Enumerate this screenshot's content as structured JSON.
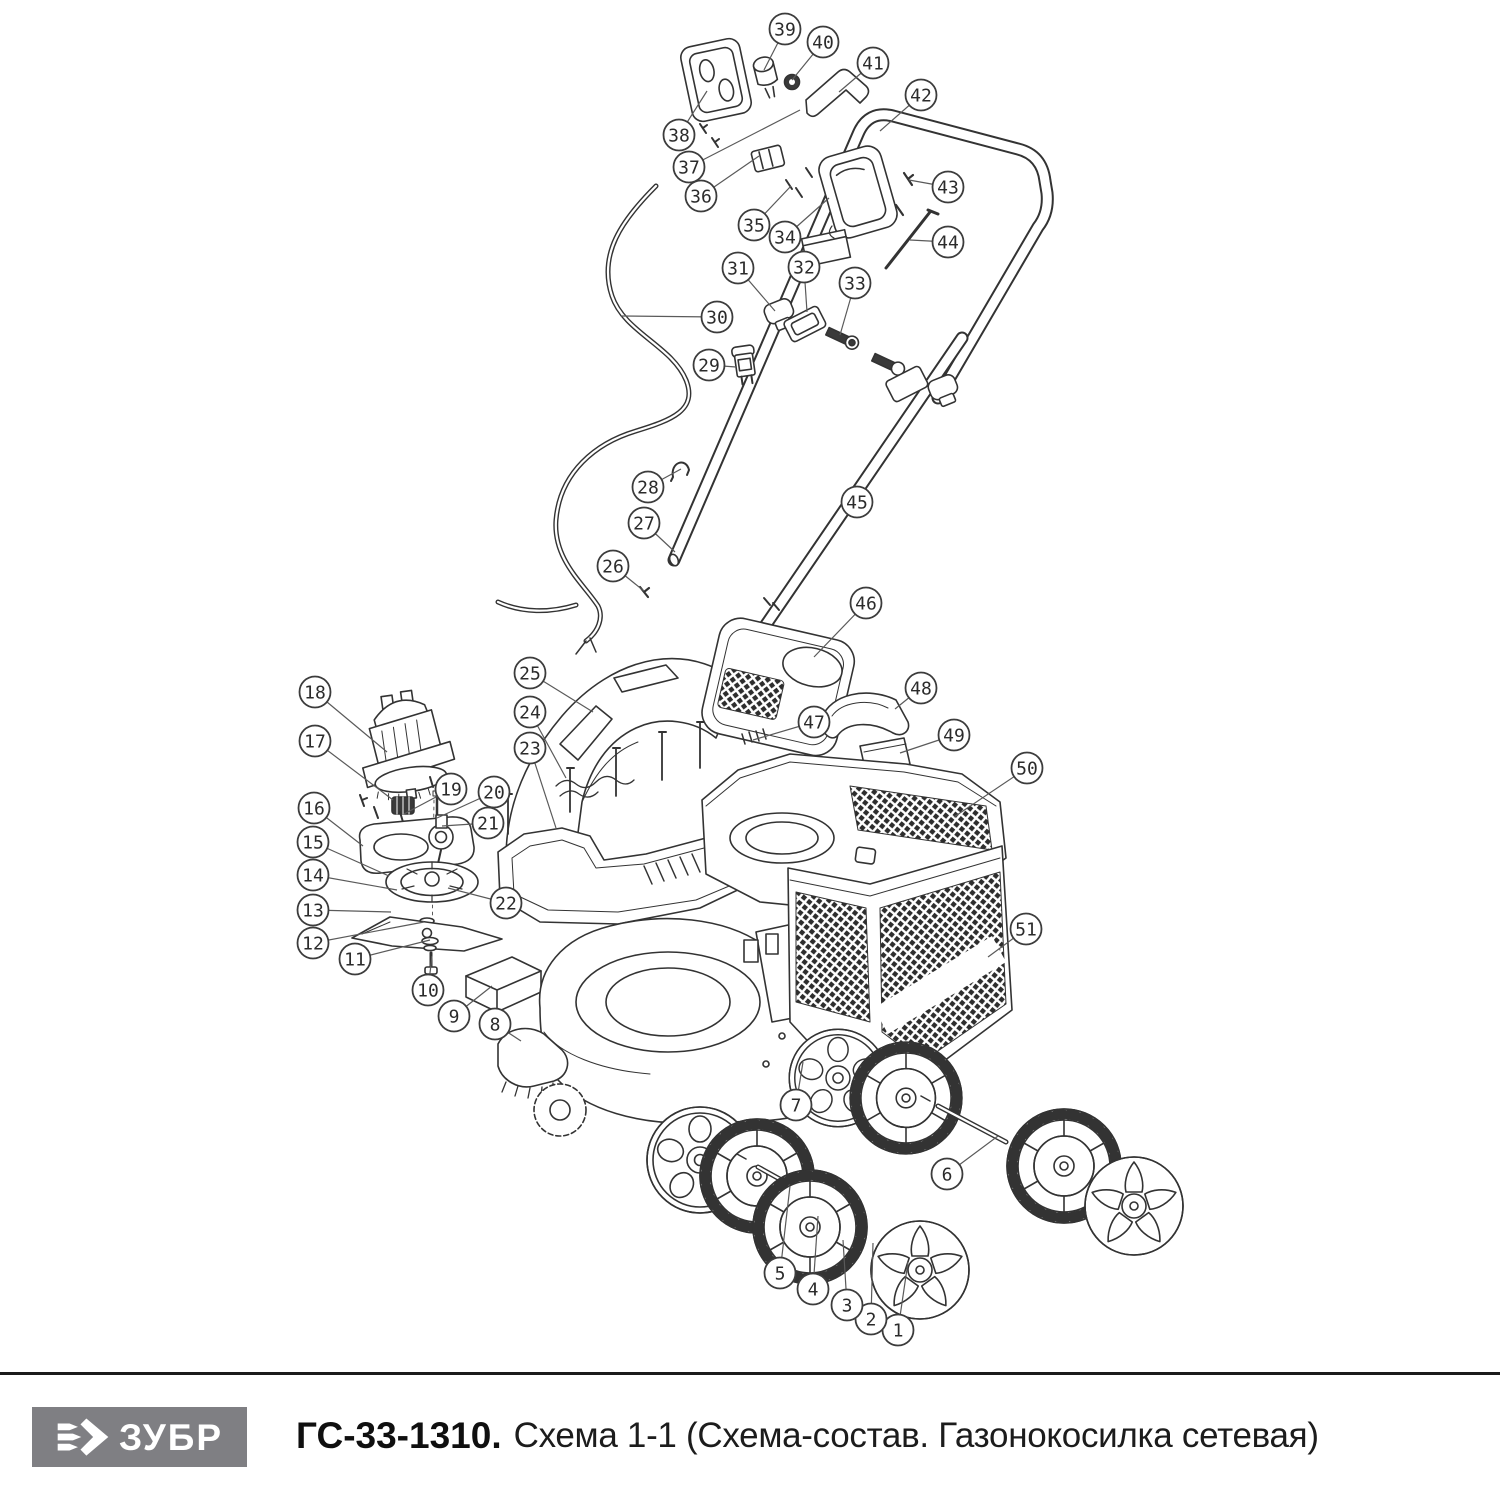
{
  "page": {
    "width": 1500,
    "height": 1500,
    "background": "#ffffff"
  },
  "diagram": {
    "type": "exploded-parts-diagram",
    "line_color": "#333333",
    "callout_style": {
      "radius": 15.5,
      "stroke": "#3c3c3c",
      "leader": "#5a5a5a",
      "number_color": "#2b2b2b",
      "font_size": 18
    },
    "callouts": [
      {
        "n": 1,
        "cx": 898,
        "cy": 1330,
        "tx": 908,
        "ty": 1262
      },
      {
        "n": 2,
        "cx": 871,
        "cy": 1319,
        "tx": 873,
        "ty": 1243
      },
      {
        "n": 3,
        "cx": 847,
        "cy": 1305,
        "tx": 843,
        "ty": 1240
      },
      {
        "n": 4,
        "cx": 813,
        "cy": 1289,
        "tx": 818,
        "ty": 1216
      },
      {
        "n": 5,
        "cx": 780,
        "cy": 1273,
        "tx": 790,
        "ty": 1186
      },
      {
        "n": 6,
        "cx": 947,
        "cy": 1174,
        "tx": 998,
        "ty": 1136
      },
      {
        "n": 7,
        "cx": 796,
        "cy": 1105,
        "tx": 803,
        "ty": 1062
      },
      {
        "n": 8,
        "cx": 495,
        "cy": 1024,
        "tx": 521,
        "ty": 1041
      },
      {
        "n": 9,
        "cx": 454,
        "cy": 1016,
        "tx": 492,
        "ty": 986
      },
      {
        "n": 10,
        "cx": 428,
        "cy": 990,
        "tx": 432,
        "ty": 956
      },
      {
        "n": 11,
        "cx": 355,
        "cy": 959,
        "tx": 430,
        "ty": 940
      },
      {
        "n": 12,
        "cx": 313,
        "cy": 943,
        "tx": 424,
        "ty": 922
      },
      {
        "n": 13,
        "cx": 313,
        "cy": 910,
        "tx": 391,
        "ty": 912
      },
      {
        "n": 14,
        "cx": 313,
        "cy": 875,
        "tx": 397,
        "ty": 890
      },
      {
        "n": 15,
        "cx": 313,
        "cy": 842,
        "tx": 389,
        "ty": 876
      },
      {
        "n": 16,
        "cx": 314,
        "cy": 808,
        "tx": 363,
        "ty": 846
      },
      {
        "n": 17,
        "cx": 315,
        "cy": 741,
        "tx": 393,
        "ty": 800
      },
      {
        "n": 18,
        "cx": 315,
        "cy": 692,
        "tx": 387,
        "ty": 752
      },
      {
        "n": 19,
        "cx": 451,
        "cy": 789,
        "tx": 404,
        "ty": 814
      },
      {
        "n": 20,
        "cx": 494,
        "cy": 792,
        "tx": 437,
        "ty": 818
      },
      {
        "n": 21,
        "cx": 488,
        "cy": 823,
        "tx": 442,
        "ty": 826
      },
      {
        "n": 22,
        "cx": 506,
        "cy": 903,
        "tx": 448,
        "ty": 888
      },
      {
        "n": 23,
        "cx": 530,
        "cy": 748,
        "tx": 556,
        "ty": 828
      },
      {
        "n": 24,
        "cx": 530,
        "cy": 712,
        "tx": 566,
        "ty": 778
      },
      {
        "n": 25,
        "cx": 530,
        "cy": 673,
        "tx": 593,
        "ty": 712
      },
      {
        "n": 26,
        "cx": 613,
        "cy": 566,
        "tx": 644,
        "ty": 591
      },
      {
        "n": 27,
        "cx": 644,
        "cy": 523,
        "tx": 675,
        "ty": 552
      },
      {
        "n": 28,
        "cx": 648,
        "cy": 487,
        "tx": 681,
        "ty": 469
      },
      {
        "n": 29,
        "cx": 709,
        "cy": 365,
        "tx": 736,
        "ty": 367
      },
      {
        "n": 30,
        "cx": 717,
        "cy": 317,
        "tx": 621,
        "ty": 316
      },
      {
        "n": 31,
        "cx": 738,
        "cy": 268,
        "tx": 775,
        "ty": 311
      },
      {
        "n": 32,
        "cx": 804,
        "cy": 267,
        "tx": 807,
        "ty": 312
      },
      {
        "n": 33,
        "cx": 855,
        "cy": 283,
        "tx": 840,
        "ty": 335
      },
      {
        "n": 34,
        "cx": 785,
        "cy": 237,
        "tx": 829,
        "ty": 198
      },
      {
        "n": 35,
        "cx": 754,
        "cy": 225,
        "tx": 791,
        "ty": 186
      },
      {
        "n": 36,
        "cx": 701,
        "cy": 196,
        "tx": 759,
        "ty": 156
      },
      {
        "n": 37,
        "cx": 689,
        "cy": 167,
        "tx": 800,
        "ty": 110
      },
      {
        "n": 38,
        "cx": 679,
        "cy": 135,
        "tx": 707,
        "ty": 91
      },
      {
        "n": 39,
        "cx": 785,
        "cy": 29,
        "tx": 764,
        "ty": 70
      },
      {
        "n": 40,
        "cx": 823,
        "cy": 42,
        "tx": 792,
        "ty": 80
      },
      {
        "n": 41,
        "cx": 873,
        "cy": 63,
        "tx": 839,
        "ty": 92
      },
      {
        "n": 42,
        "cx": 921,
        "cy": 95,
        "tx": 880,
        "ty": 131
      },
      {
        "n": 43,
        "cx": 948,
        "cy": 187,
        "tx": 909,
        "ty": 180
      },
      {
        "n": 44,
        "cx": 948,
        "cy": 242,
        "tx": 910,
        "ty": 240
      },
      {
        "n": 45,
        "cx": 857,
        "cy": 502,
        "tx": 853,
        "ty": 497
      },
      {
        "n": 46,
        "cx": 866,
        "cy": 603,
        "tx": 814,
        "ty": 657
      },
      {
        "n": 47,
        "cx": 814,
        "cy": 722,
        "tx": 753,
        "ty": 740
      },
      {
        "n": 48,
        "cx": 921,
        "cy": 688,
        "tx": 895,
        "ty": 709
      },
      {
        "n": 49,
        "cx": 954,
        "cy": 735,
        "tx": 900,
        "ty": 753
      },
      {
        "n": 50,
        "cx": 1027,
        "cy": 768,
        "tx": 954,
        "ty": 817
      },
      {
        "n": 51,
        "cx": 1026,
        "cy": 929,
        "tx": 988,
        "ty": 957
      }
    ]
  },
  "footer": {
    "divider_color": "#1b1b1b",
    "logo": {
      "text": "ЗУБР",
      "bg": "#7f7f83",
      "fg": "#ffffff"
    },
    "model": "ГС-33-1310.",
    "caption": "Схема 1-1 (Схема-состав. Газонокосилка сетевая)"
  }
}
